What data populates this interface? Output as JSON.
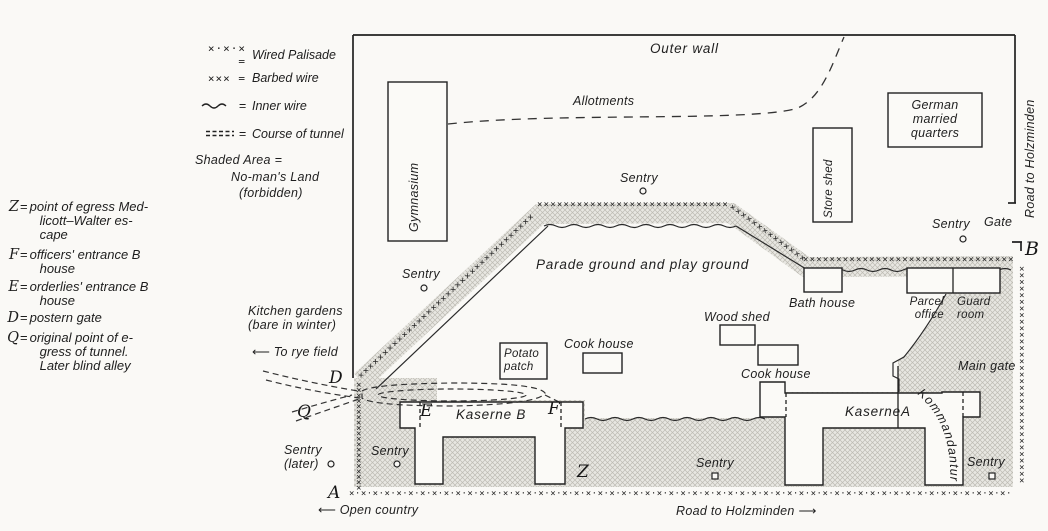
{
  "colors": {
    "paper": "#faf9f6",
    "ink": "#1e1e1e",
    "hatch_bg": "#e8e7e2",
    "hatch_line": "#bdbbb3",
    "building_fill": "#fbfaf7"
  },
  "legend": {
    "symbol_items": [
      {
        "icon": "wired-palisade-symbol",
        "symbol_text": "×·×·× =",
        "label": "Wired Palisade"
      },
      {
        "icon": "barbed-wire-symbol",
        "symbol_text": "××× =",
        "label": "Barbed wire"
      },
      {
        "icon": "inner-wire-symbol",
        "symbol_text": "",
        "label": "Inner wire"
      },
      {
        "icon": "tunnel-course-symbol",
        "symbol_text": "",
        "label": "Course of tunnel"
      }
    ],
    "shaded": {
      "l1": "Shaded Area =",
      "l2": "No-man's Land",
      "l3": "(forbidden)"
    },
    "eq": "=",
    "keys": [
      {
        "letter": "Z",
        "lines": [
          "point of egress Med-",
          "licott–Walter es-",
          "cape"
        ]
      },
      {
        "letter": "F",
        "lines": [
          "officers' entrance B",
          "house"
        ]
      },
      {
        "letter": "E",
        "lines": [
          "orderlies' entrance B",
          "house"
        ]
      },
      {
        "letter": "D",
        "lines": [
          "postern gate"
        ]
      },
      {
        "letter": "Q",
        "lines": [
          "original point of e-",
          "gress of tunnel.",
          "Later blind alley"
        ]
      }
    ]
  },
  "map": {
    "outer_wall": "Outer wall",
    "allotments": "Allotments",
    "gymnasium": "Gymnasium",
    "store_shed": "Store shed",
    "german_quarters": {
      "l1": "German",
      "l2": "married",
      "l3": "quarters"
    },
    "road_right": "Road to Holzminden",
    "gate": "Gate",
    "sentry": "Sentry",
    "sentry_later": {
      "l1": "Sentry",
      "l2": "(later)"
    },
    "parade": "Parade ground and play ground",
    "bath_house": "Bath house",
    "parcel_office": {
      "l1": "Parcel",
      "l2": "office"
    },
    "guard_room": {
      "l1": "Guard",
      "l2": "room"
    },
    "main_gate": "Main gate",
    "wood_shed": "Wood shed",
    "cook_house_1": "Cook house",
    "cook_house_2": "Cook house",
    "potato_patch": {
      "l1": "Potato",
      "l2": "patch"
    },
    "kitchen_gardens": {
      "l1": "Kitchen gardens",
      "l2": "(bare in winter)"
    },
    "to_rye_field": "To rye field",
    "kaserne_b": "Kaserne B",
    "kaserne_a_word": "Kaserne",
    "kaserne_a_letter": "A",
    "kommandantur": "Kommandantur",
    "open_country": "Open country",
    "road_bottom": "Road to Holzminden",
    "arrow_left": "⟵",
    "arrow_right": "⟶",
    "letters": {
      "D": "D",
      "Q": "Q",
      "E": "E",
      "F": "F",
      "Z": "Z",
      "A": "A",
      "B": "B"
    }
  }
}
